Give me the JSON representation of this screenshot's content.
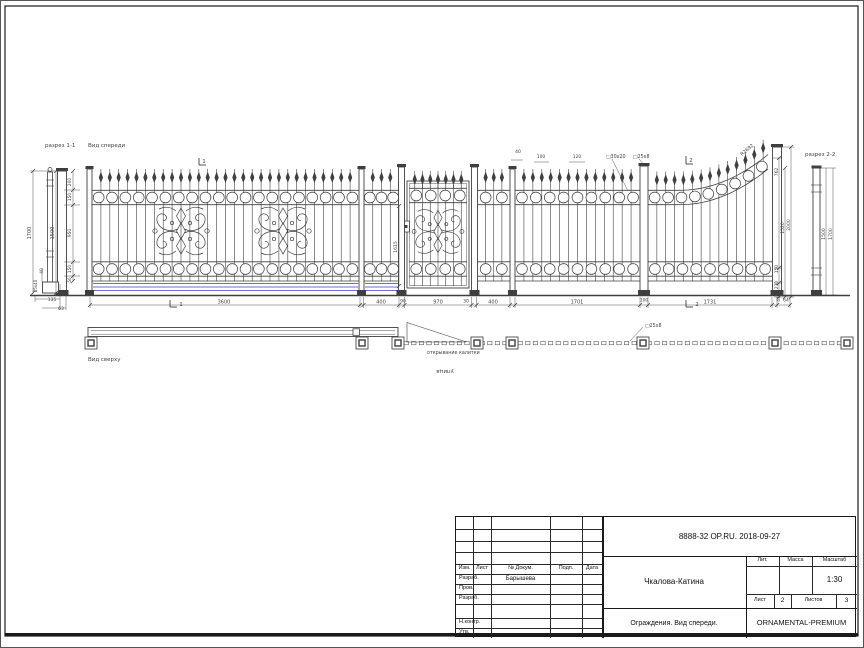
{
  "colors": {
    "line": "#3f3f3f",
    "dark": "#1a1a1a",
    "blue": "#3b3bd0",
    "bg": "#ffffff"
  },
  "title_block": {
    "doc_code": "8888-32 OP.RU. 2018-09-27",
    "object_name": "Чкалова-Катина",
    "doc_title": "Ограждения. Вид спереди.",
    "brand": "ORNAMENTAL-PREMIUM",
    "scale": "1:30",
    "lit": "Лит.",
    "mass": "Масса",
    "masshtab": "Масштаб",
    "sheet_label": "Лист",
    "sheet": "2",
    "sheets_label": "Листов",
    "sheets": "3",
    "headers": {
      "izm": "Изм.",
      "list": "Лист",
      "doc": "№ Докум.",
      "podp": "Подп.",
      "data": "Дата"
    },
    "rows": {
      "r1": "Разраб.",
      "r1_value": "Барышева",
      "r2": "Пров.",
      "r3": "Разраб.",
      "r4": "Н.контр.",
      "r5": "Утв."
    }
  },
  "annotations": [
    {
      "t": "разрез 1-1",
      "x": 45,
      "y": 147,
      "a": "start",
      "s": 5.5
    },
    {
      "t": "Вид спереди",
      "x": 88,
      "y": 147,
      "a": "start",
      "s": 5.5
    },
    {
      "t": "разрез 2-2",
      "x": 805,
      "y": 156,
      "a": "start",
      "s": 5.5
    },
    {
      "t": "Вид сверху",
      "x": 88,
      "y": 361,
      "a": "start",
      "s": 5.5
    },
    {
      "t": "открывание калитки",
      "x": 427,
      "y": 354,
      "a": "start",
      "s": 4.8
    },
    {
      "t": "улица",
      "x": 445,
      "y": 370,
      "s": 5.5,
      "r": 180
    },
    {
      "t": "□25х8",
      "x": 645,
      "y": 327,
      "a": "start",
      "s": 4.8
    },
    {
      "t": "□30х20",
      "x": 606,
      "y": 158,
      "a": "start",
      "s": 4.8
    },
    {
      "t": "□25х8",
      "x": 633,
      "y": 158,
      "a": "start",
      "s": 4.8
    },
    {
      "t": "R2692",
      "x": 748,
      "y": 151,
      "s": 4.8,
      "r": -40
    },
    {
      "t": "1",
      "x": 204,
      "y": 163,
      "s": 5.5
    },
    {
      "t": "2",
      "x": 691,
      "y": 162,
      "s": 5.5
    },
    {
      "t": "1",
      "x": 181,
      "y": 306,
      "s": 5.5
    },
    {
      "t": "2",
      "x": 697,
      "y": 306,
      "s": 5.5
    },
    {
      "t": "3600",
      "x": 224,
      "y": 303.5,
      "s": 5
    },
    {
      "t": "400",
      "x": 381,
      "y": 303.5,
      "s": 5
    },
    {
      "t": "90",
      "x": 403,
      "y": 302.5,
      "s": 4.5
    },
    {
      "t": "970",
      "x": 438,
      "y": 303.5,
      "s": 5
    },
    {
      "t": "30",
      "x": 466,
      "y": 302.5,
      "s": 4.5
    },
    {
      "t": "400",
      "x": 493,
      "y": 303.5,
      "s": 5
    },
    {
      "t": "1701",
      "x": 577,
      "y": 303.5,
      "s": 5
    },
    {
      "t": "100",
      "x": 644,
      "y": 301.5,
      "s": 4.5
    },
    {
      "t": "1731",
      "x": 710,
      "y": 303.5,
      "s": 5
    },
    {
      "t": "64",
      "x": 786,
      "y": 301.5,
      "s": 4.5
    },
    {
      "t": "40",
      "x": 518,
      "y": 153,
      "s": 4.5
    },
    {
      "t": "100",
      "x": 541,
      "y": 158,
      "s": 4.5
    },
    {
      "t": "120",
      "x": 577,
      "y": 158,
      "s": 4.5
    },
    {
      "t": "1700",
      "x": 31,
      "y": 233,
      "s": 5,
      "r": -90
    },
    {
      "t": "1500",
      "x": 54,
      "y": 233,
      "s": 5,
      "r": -90
    },
    {
      "t": "200",
      "x": 71,
      "y": 182,
      "s": 4.5,
      "r": -90
    },
    {
      "t": "150",
      "x": 71,
      "y": 197,
      "s": 4.5,
      "r": -90
    },
    {
      "t": "950",
      "x": 71,
      "y": 233,
      "s": 4.5,
      "r": -90
    },
    {
      "t": "150",
      "x": 71,
      "y": 269,
      "s": 4.5,
      "r": -90
    },
    {
      "t": "50",
      "x": 71,
      "y": 280,
      "s": 4,
      "r": -90
    },
    {
      "t": "40",
      "x": 43,
      "y": 271,
      "s": 4.5,
      "r": -90
    },
    {
      "t": "85х40",
      "x": 37,
      "y": 286,
      "s": 4,
      "r": -90
    },
    {
      "t": "135",
      "x": 52,
      "y": 301,
      "s": 4.5
    },
    {
      "t": "63",
      "x": 61,
      "y": 310,
      "s": 4.5
    },
    {
      "t": "1615",
      "x": 397,
      "y": 247,
      "s": 4.5,
      "r": -90
    },
    {
      "t": "762",
      "x": 778,
      "y": 172,
      "s": 4.5,
      "r": -90
    },
    {
      "t": "1520",
      "x": 784,
      "y": 228,
      "s": 4.5,
      "r": -90
    },
    {
      "t": "2000",
      "x": 790,
      "y": 225,
      "s": 4.5,
      "r": -90
    },
    {
      "t": "150",
      "x": 778,
      "y": 269,
      "s": 4.5,
      "r": -90
    },
    {
      "t": "230",
      "x": 778,
      "y": 285,
      "s": 4.5,
      "r": -90
    },
    {
      "t": "64",
      "x": 780,
      "y": 299,
      "s": 4,
      "r": -90
    },
    {
      "t": "1500",
      "x": 825,
      "y": 234,
      "s": 4.5,
      "r": -90
    },
    {
      "t": "1700",
      "x": 832,
      "y": 234,
      "s": 4.5,
      "r": -90
    }
  ]
}
